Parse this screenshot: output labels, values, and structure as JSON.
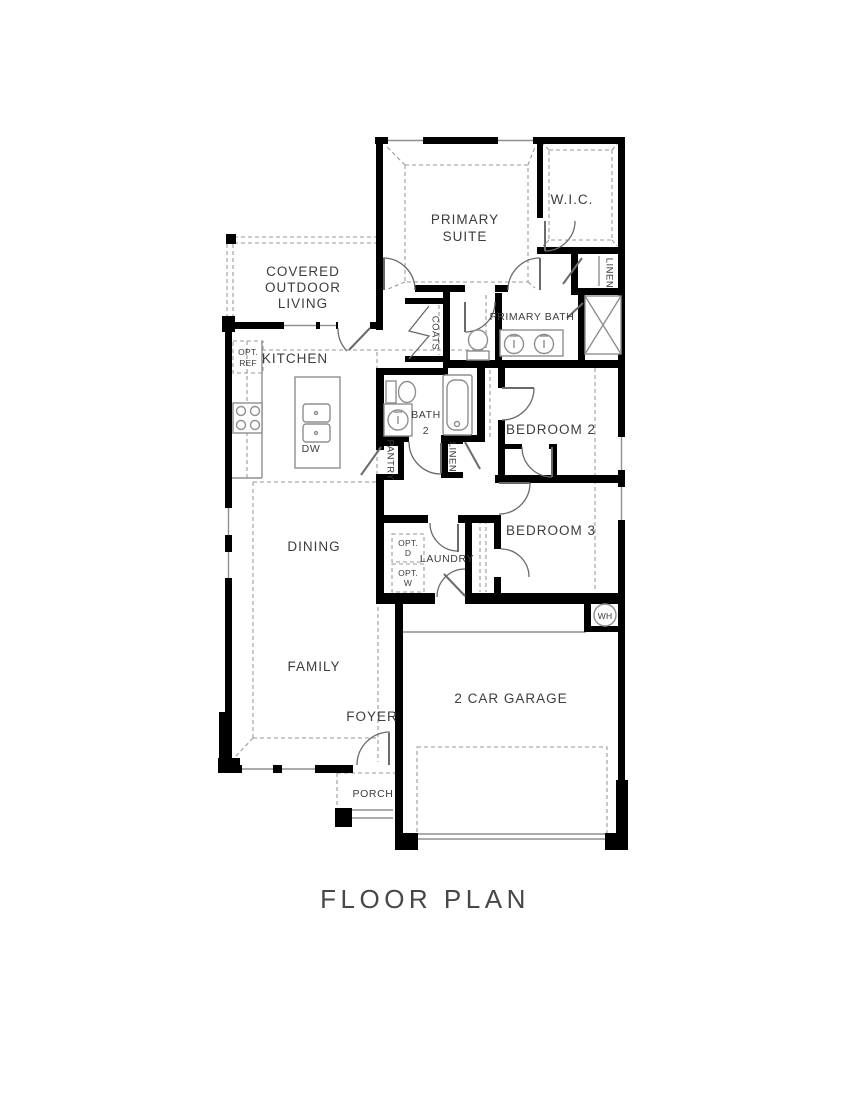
{
  "title": "FLOOR PLAN",
  "colors": {
    "wall": "#000000",
    "line": "#8f8f8f",
    "dash": "#9a9a9a",
    "door": "#6a6a6a",
    "text": "#3d3d3d",
    "background": "#ffffff"
  },
  "labels": {
    "primary_suite_1": "PRIMARY",
    "primary_suite_2": "SUITE",
    "wic": "W.I.C.",
    "linen_upper": "LINEN",
    "primary_bath": "PRIMARY BATH",
    "coats": "COATS",
    "bath2_1": "BATH",
    "bath2_2": "2",
    "bedroom2": "BEDROOM 2",
    "pantry": "PANTRY",
    "linen_hall": "LINEN",
    "kitchen": "KITCHEN",
    "opt_ref_1": "OPT.",
    "opt_ref_2": "REF",
    "dw": "DW",
    "outdoor_1": "COVERED",
    "outdoor_2": "OUTDOOR",
    "outdoor_3": "LIVING",
    "dining": "DINING",
    "laundry": "LAUNDRY",
    "opt_d_1": "OPT.",
    "opt_d_2": "D",
    "opt_w_1": "OPT.",
    "opt_w_2": "W",
    "bedroom3": "BEDROOM 3",
    "water_heater": "WH",
    "family": "FAMILY",
    "foyer": "FOYER",
    "garage": "2 CAR GARAGE",
    "porch": "PORCH"
  }
}
